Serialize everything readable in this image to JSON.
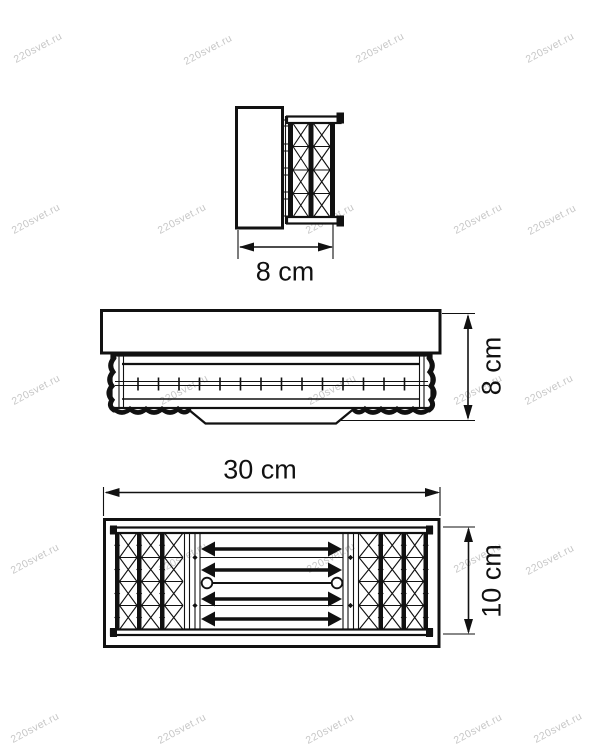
{
  "page": {
    "background": "#ffffff",
    "ink_color": "#111111"
  },
  "watermark": {
    "text": "220svet.ru",
    "color": "#c7c7c7"
  },
  "dimensions": {
    "side_width": "8 cm",
    "front_height": "8 cm",
    "plan_width": "30 cm",
    "plan_height": "10 cm"
  }
}
